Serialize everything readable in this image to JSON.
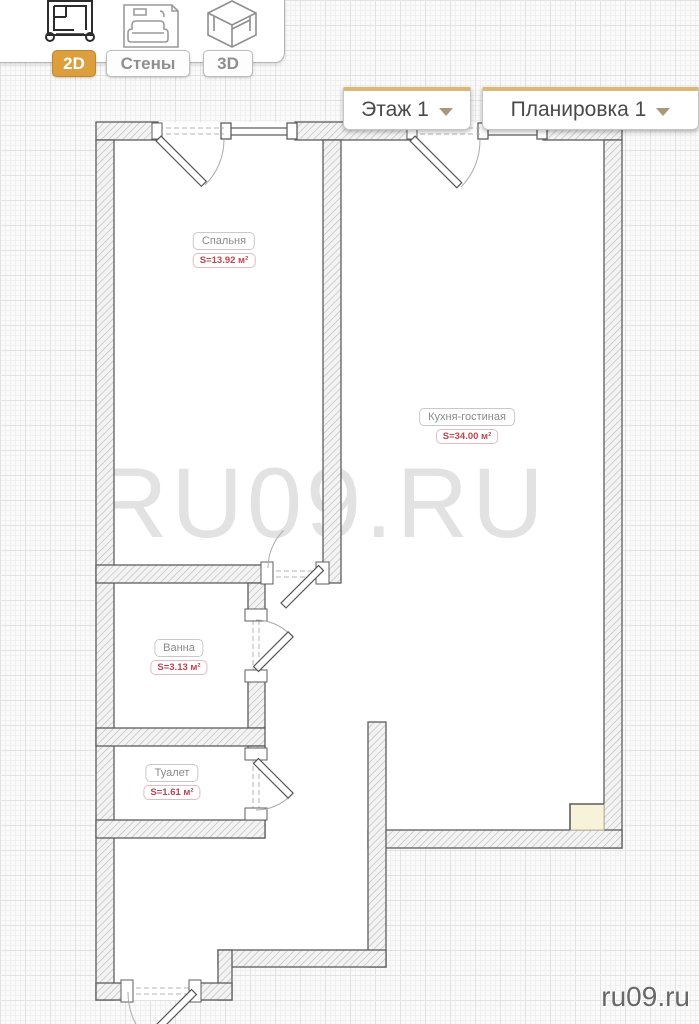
{
  "toolbar": {
    "tabs": [
      {
        "id": "2d",
        "label": "2D",
        "active": true,
        "icon": "blueprint-icon"
      },
      {
        "id": "walls",
        "label": "Стены",
        "active": false,
        "icon": "sofa-icon"
      },
      {
        "id": "3d",
        "label": "3D",
        "active": false,
        "icon": "room-3d-icon"
      }
    ]
  },
  "selectors": {
    "floor": {
      "label": "Этаж 1"
    },
    "layout": {
      "label": "Планировка 1"
    }
  },
  "rooms": [
    {
      "name": "Спальня",
      "area": "S=13.92 м²"
    },
    {
      "name": "Кухня-гостиная",
      "area": "S=34.00 м²"
    },
    {
      "name": "Ванна",
      "area": "S=3.13 м²"
    },
    {
      "name": "Туалет",
      "area": "S=1.61 м²"
    }
  ],
  "watermark": "RU09.RU",
  "site_label": "ru09.ru",
  "colors": {
    "active_tab": "#dd9f3d",
    "selector_accent": "#dcb878",
    "area_text": "#bb4450",
    "wall_stroke": "#5d5d5d"
  }
}
